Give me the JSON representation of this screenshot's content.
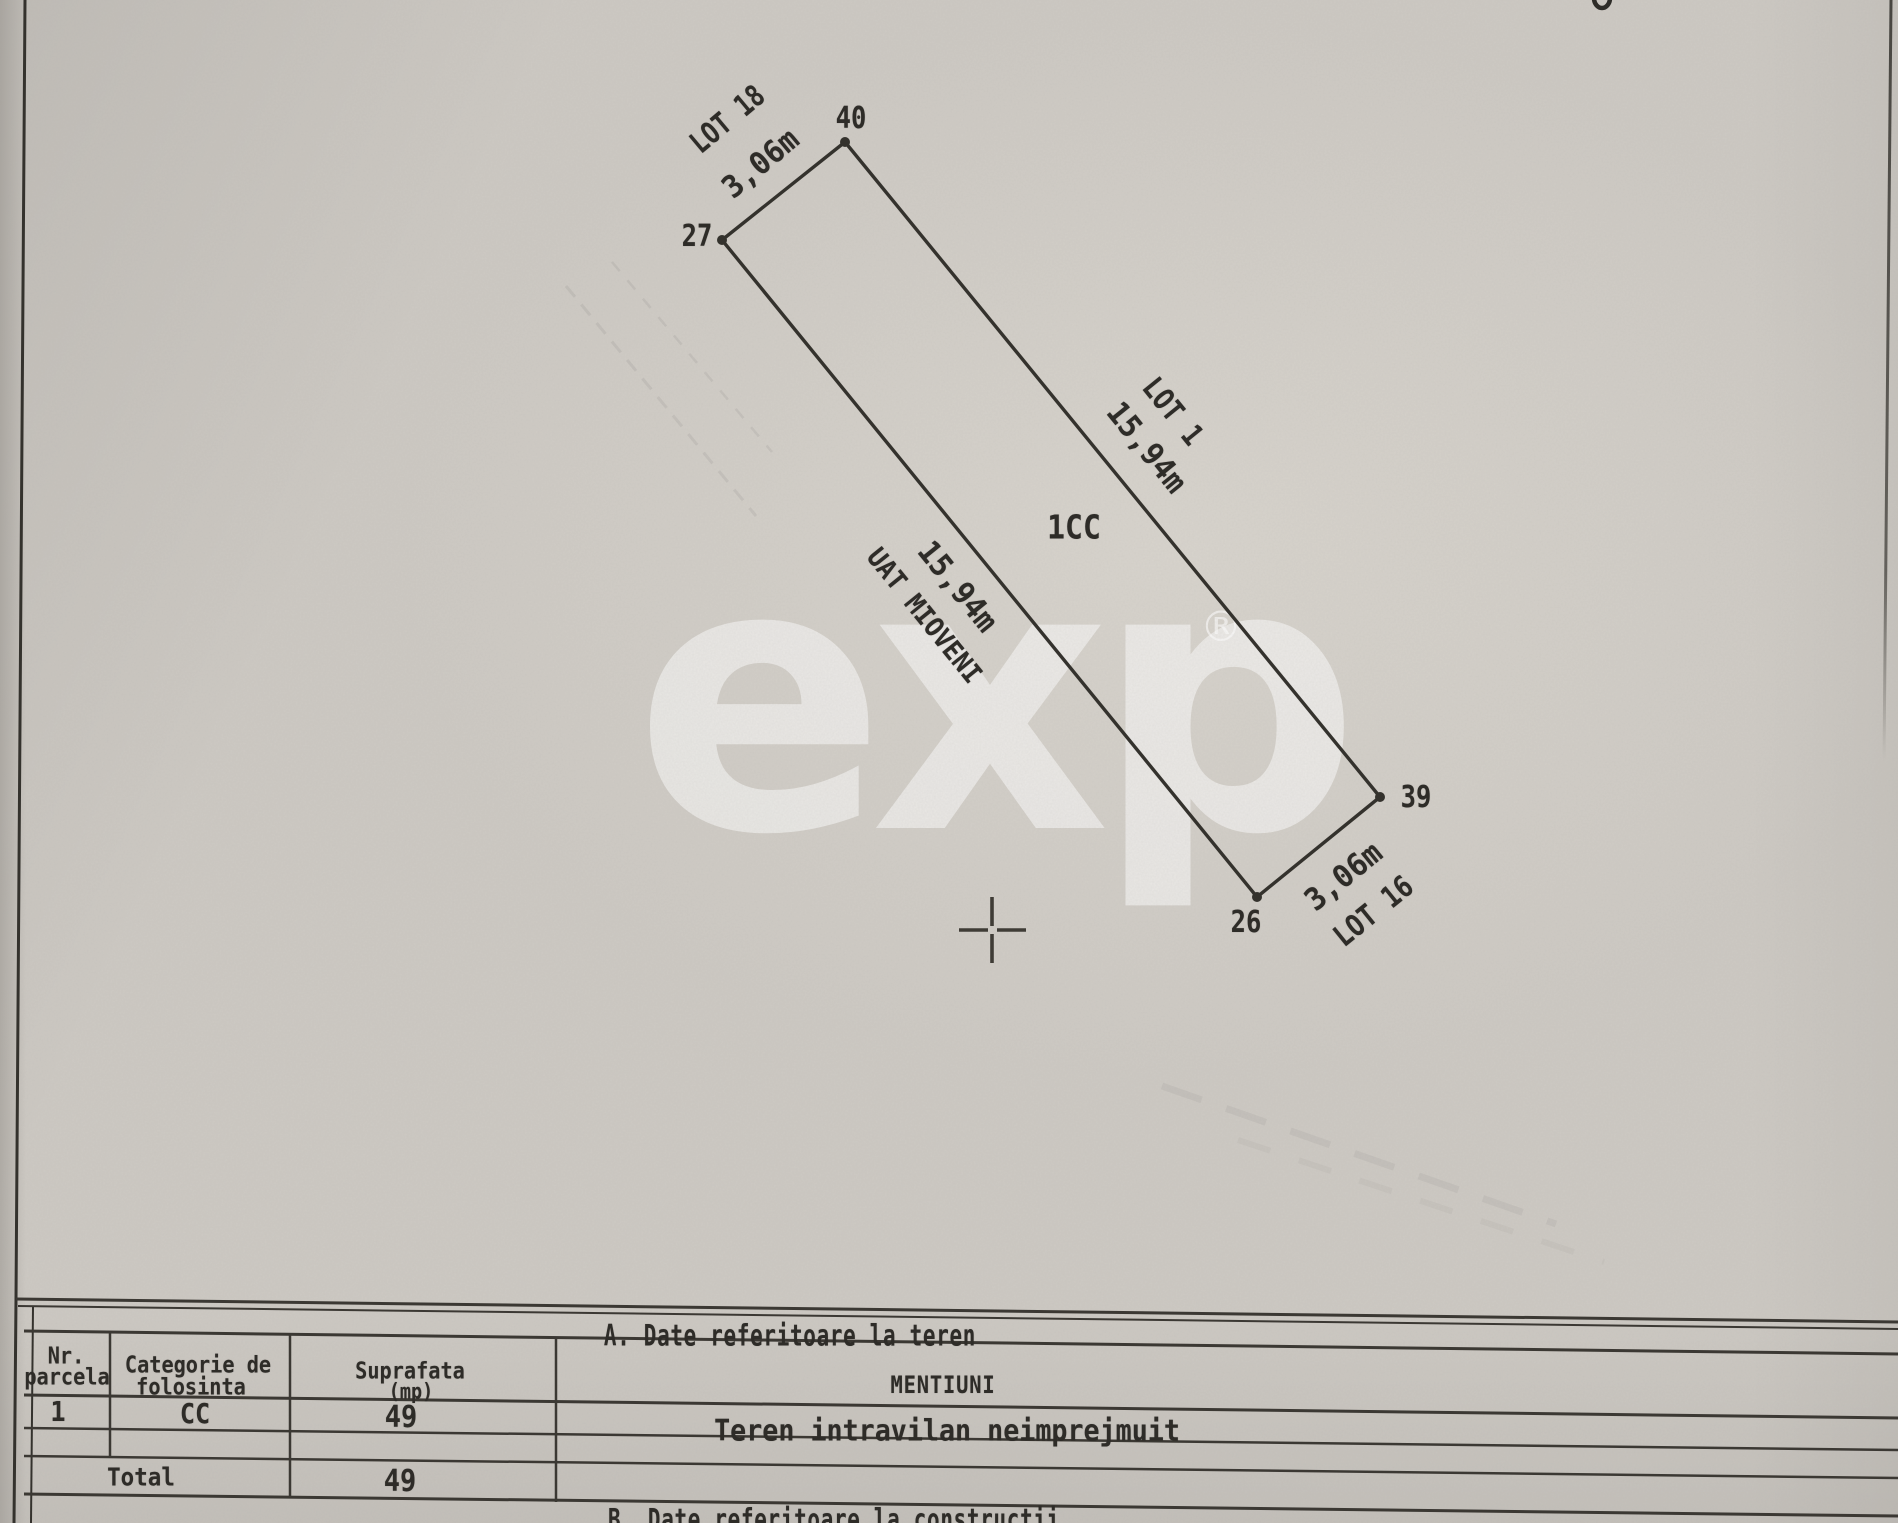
{
  "colors": {
    "paper": "#cdc9c3",
    "ink": "#2e2c28",
    "watermark": "#ffffff"
  },
  "watermark": {
    "brand": "exp",
    "registered": "®"
  },
  "plan": {
    "parcel_code": "1CC",
    "admin_unit": "UAT MIOVENI",
    "points": {
      "p40": "40",
      "p27": "27",
      "p26": "26",
      "p39": "39"
    },
    "lots": {
      "top": "LOT 18",
      "right": "LOT 1",
      "bottom": "LOT 16"
    },
    "dims": {
      "top": "3,06m",
      "right": "15,94m",
      "left": "15,94m",
      "bottom": "3,06m"
    }
  },
  "table_a": {
    "title": "A. Date referitoare la teren",
    "header": {
      "nr_1": "Nr.",
      "nr_2": "parcela",
      "cat_1": "Categorie de",
      "cat_2": "folosinta",
      "sup_1": "Suprafata",
      "sup_2": "(mp)",
      "mentiuni": "MENTIUNI"
    },
    "row1": {
      "nr": "1",
      "categorie": "CC",
      "suprafata": "49",
      "mentiuni": "Teren intravilan neimprejmuit"
    },
    "total": {
      "label": "Total",
      "suprafata": "49"
    }
  },
  "section_b": {
    "title": "B. Date referitoare la constructii"
  }
}
